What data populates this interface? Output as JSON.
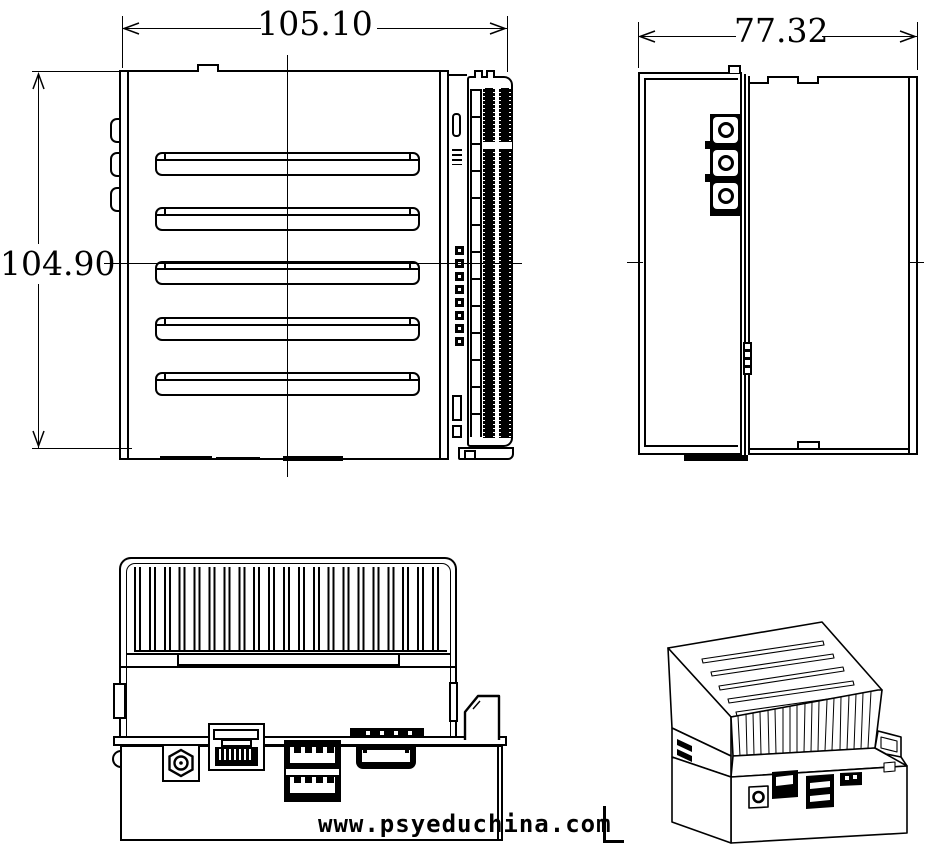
{
  "colors": {
    "line": "#000000",
    "background": "#ffffff"
  },
  "views": {
    "front": {
      "width_label": "105.10",
      "height_label": "104.90"
    },
    "side": {
      "width_label": "77.32"
    }
  },
  "watermark": {
    "text": "www.psyeduchina.com"
  }
}
